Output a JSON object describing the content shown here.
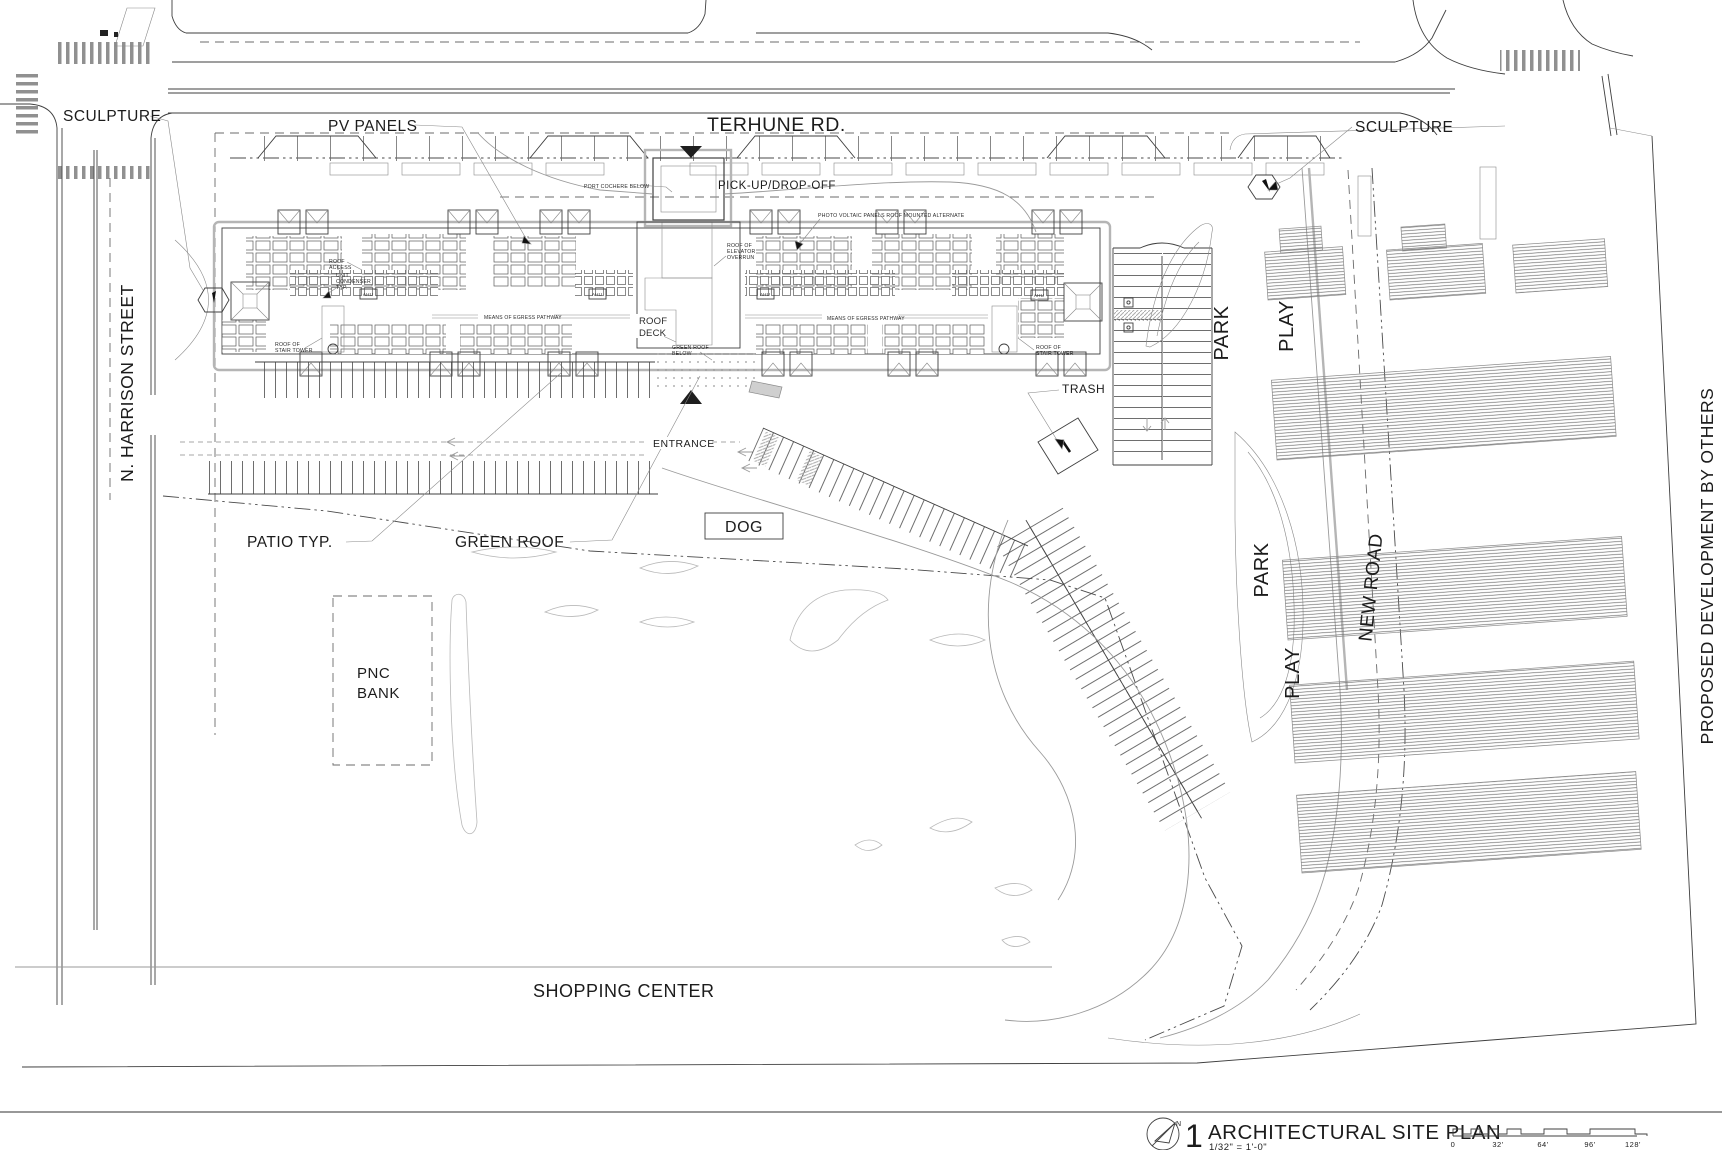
{
  "title_block": {
    "sheet_number": "1",
    "title": "ARCHITECTURAL SITE PLAN",
    "scale": "1/32\" = 1'-0\"",
    "north_label": "N",
    "scale_bar_ticks": [
      "0",
      "32'",
      "64'",
      "96'",
      "128'"
    ]
  },
  "streets": {
    "terhune_rd": "TERHUNE RD.",
    "n_harrison": "N. HARRISON STREET",
    "new_road": "NEW ROAD"
  },
  "areas": {
    "park_upper": "PARK",
    "play_upper": "PLAY",
    "park_lower": "PARK",
    "play_lower": "PLAY",
    "dog": "DOG",
    "shopping_center": "SHOPPING CENTER",
    "pnc_bank": [
      "PNC",
      "BANK"
    ],
    "proposed_dev": "PROPOSED DEVELOPMENT BY OTHERS"
  },
  "callouts": {
    "sculpture_left": "SCULPTURE",
    "sculpture_right": "SCULPTURE",
    "pv_panels": "PV PANELS",
    "pickup_dropoff": "PICK-UP/DROP-OFF",
    "trash": "TRASH",
    "entrance": "ENTRANCE",
    "patio_typ": "PATIO TYP.",
    "green_roof": "GREEN ROOF"
  },
  "roof_notes": {
    "port_cochere": "PORT COCHERE BELOW",
    "pv_alternate": "PHOTO VOLTAIC PANELS ROOF MOUNTED ALTERNATE",
    "roof_access": [
      "ROOF",
      "ACCESS"
    ],
    "unit_condenser": [
      "UNIT",
      "CONDENSER",
      "TYP."
    ],
    "elev_overrun": [
      "ROOF OF",
      "ELEVATOR",
      "OVERRUN"
    ],
    "roof_deck": [
      "ROOF",
      "DECK"
    ],
    "green_roof_below": [
      "GREEN ROOF",
      "BELOW"
    ],
    "stair_tower_left": [
      "ROOF OF",
      "STAIR TOWER"
    ],
    "stair_tower_right": [
      "ROOF OF",
      "STAIR TOWER"
    ],
    "egress_left": "MEANS OF EGRESS PATHWAY",
    "egress_right": "MEANS OF EGRESS PATHWAY",
    "ahu": "AHU"
  }
}
